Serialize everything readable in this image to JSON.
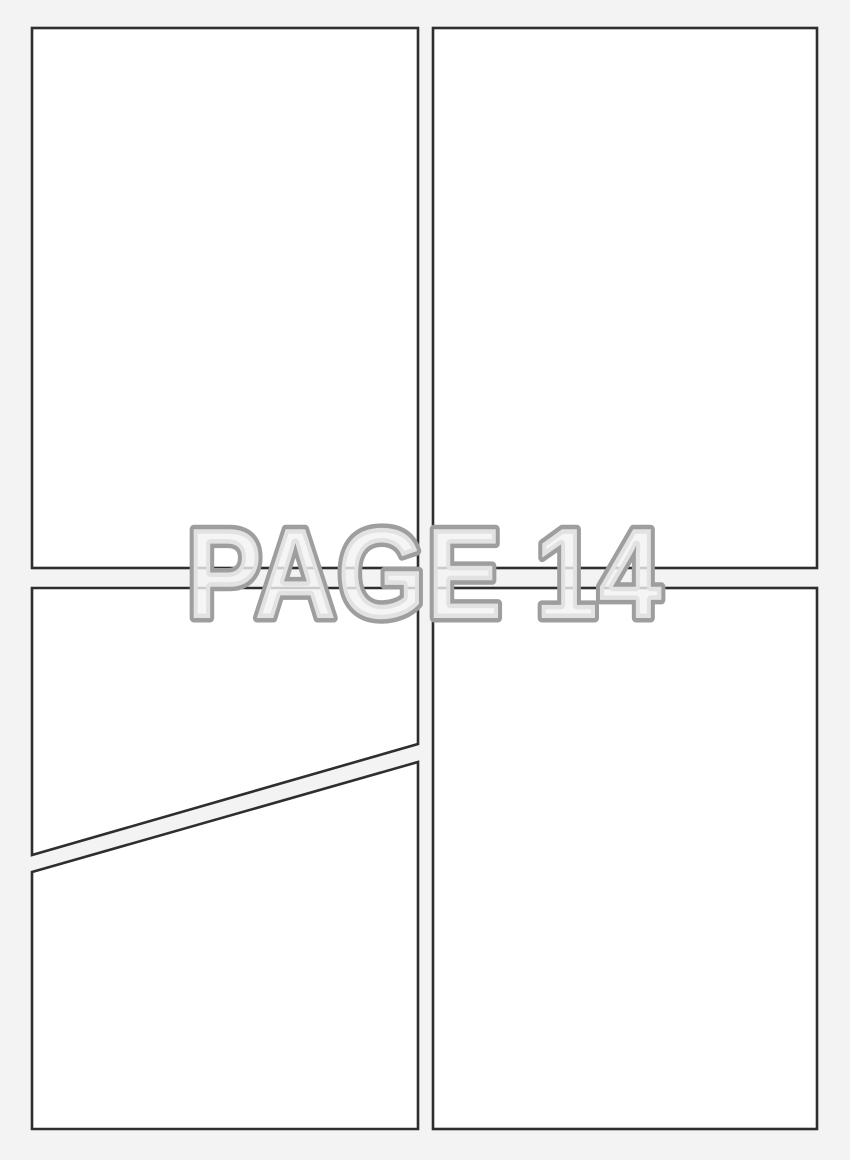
{
  "watermark": {
    "text": "PAGE 14"
  },
  "colors": {
    "background": "#f3f3f4",
    "panel_fill": "#ffffff",
    "panel_border": "#2e2e2e",
    "watermark_outline": "#9e9e9e",
    "watermark_fill": "#f2f2f3"
  }
}
